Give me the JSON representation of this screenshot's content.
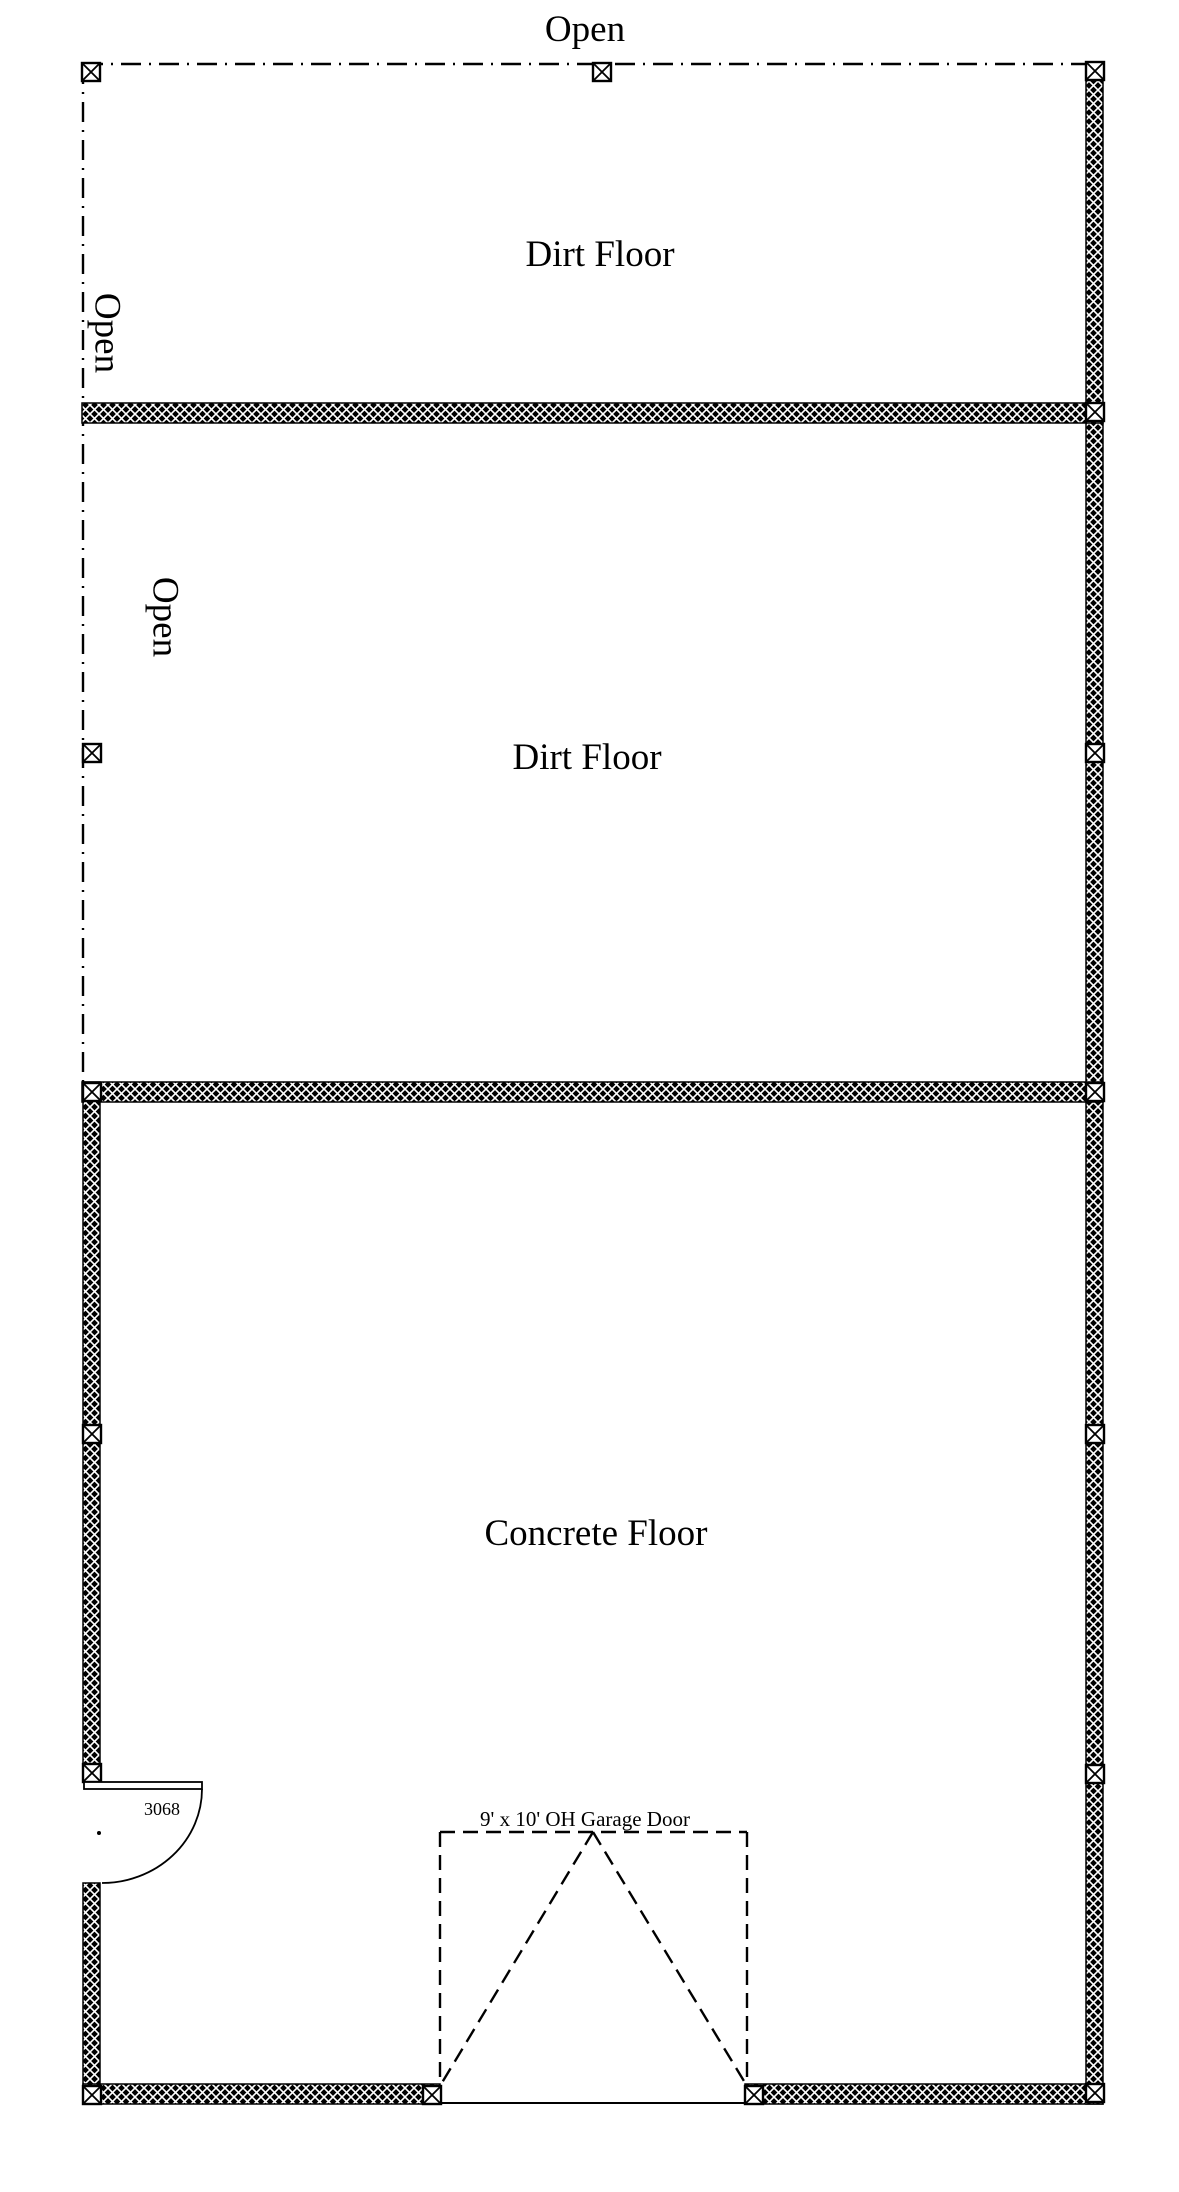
{
  "document": {
    "type": "floor-plan"
  },
  "colors": {
    "ink": "#000000",
    "paper": "#ffffff"
  },
  "labels": {
    "open_top": "Open",
    "open_upper_left": "Open",
    "open_lower_left": "Open",
    "dirt_floor_upper": "Dirt Floor",
    "dirt_floor_middle": "Dirt Floor",
    "concrete_floor": "Concrete Floor",
    "entry_door": "3068",
    "garage_door": "9' x 10' OH Garage Door"
  }
}
